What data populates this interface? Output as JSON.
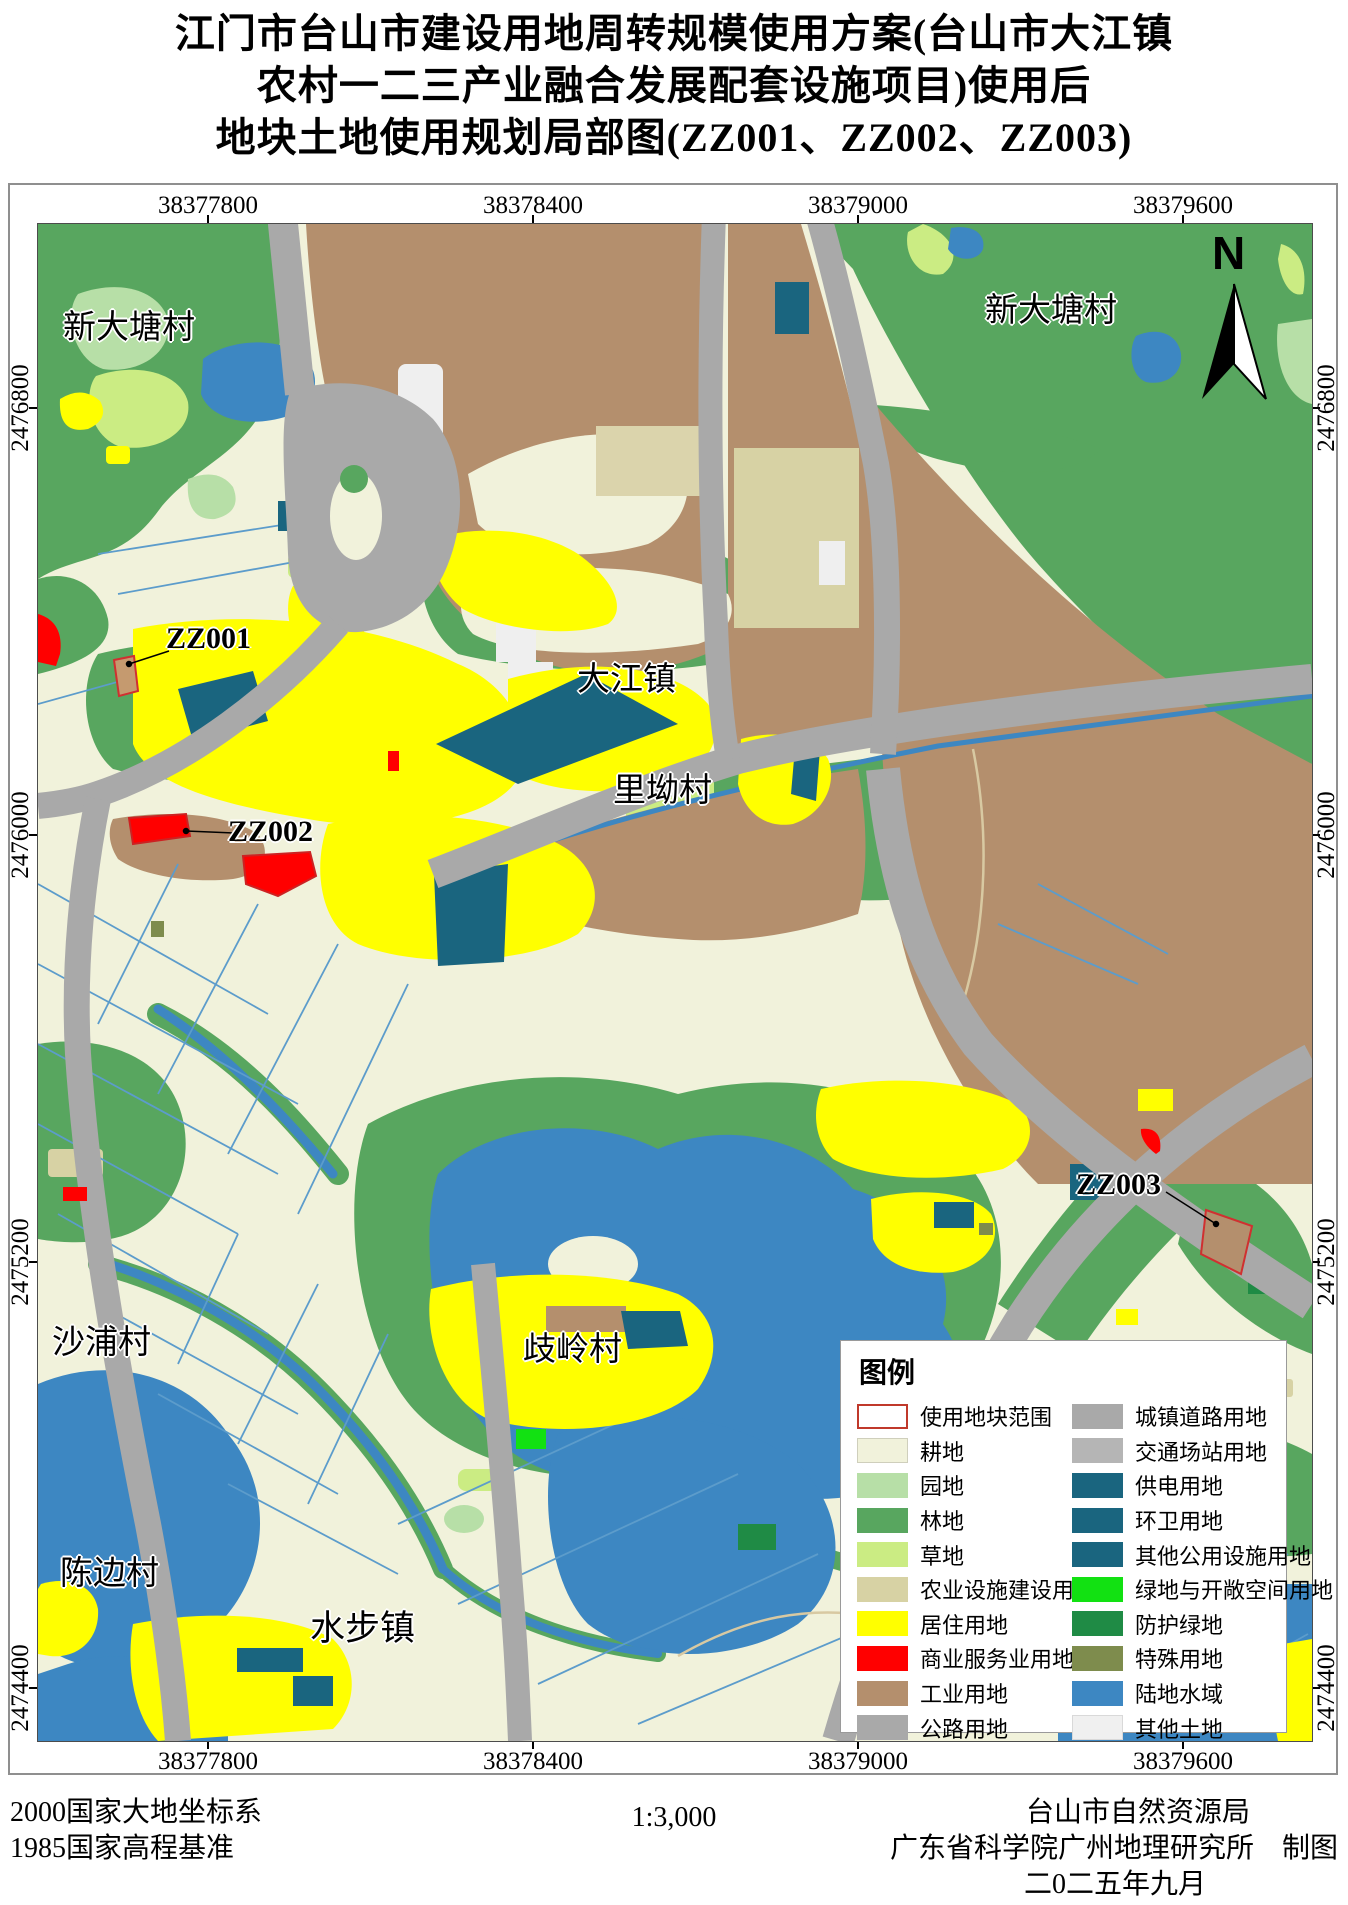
{
  "title": {
    "line1": "江门市台山市建设用地周转规模使用方案(台山市大江镇",
    "line2": "农村一二三产业融合发展配套设施项目)使用后",
    "line3": "地块土地使用规划局部图(ZZ001、ZZ002、ZZ003)"
  },
  "map": {
    "north_label": "N",
    "x_ticks": [
      "38377800",
      "38378400",
      "38379000",
      "38379600"
    ],
    "y_ticks": [
      "2476800",
      "2476000",
      "2475200",
      "2474400"
    ],
    "labels": {
      "xindatang_left": "新大塘村",
      "xindatang_right": "新大塘村",
      "dajiang": "大江镇",
      "liao": "里坳村",
      "shapu": "沙浦村",
      "qiling": "歧岭村",
      "chenbian": "陈边村",
      "shuibu": "水步镇"
    },
    "parcels": {
      "zz001": "ZZ001",
      "zz002": "ZZ002",
      "zz003": "ZZ003"
    }
  },
  "legend": {
    "title": "图例",
    "columns": [
      [
        {
          "label": "使用地块范围",
          "color": "#FFFFFF",
          "border": "2px solid #C0392B"
        },
        {
          "label": "耕地",
          "color": "#F1F2DB",
          "border": "1px solid #cfcfbc"
        },
        {
          "label": "园地",
          "color": "#B7DFA7"
        },
        {
          "label": "林地",
          "color": "#58A65F"
        },
        {
          "label": "草地",
          "color": "#CBEC83"
        },
        {
          "label": "农业设施建设用地",
          "color": "#D7D2A4"
        },
        {
          "label": "居住用地",
          "color": "#FFFF00"
        },
        {
          "label": "商业服务业用地",
          "color": "#FF0000"
        },
        {
          "label": "工业用地",
          "color": "#B48F6D"
        },
        {
          "label": "公路用地",
          "color": "#A9A9A9"
        }
      ],
      [
        {
          "label": "城镇道路用地",
          "color": "#A9A9A9"
        },
        {
          "label": "交通场站用地",
          "color": "#B5B5B5"
        },
        {
          "label": "供电用地",
          "color": "#1A657F"
        },
        {
          "label": "环卫用地",
          "color": "#1A657F"
        },
        {
          "label": "其他公用设施用地",
          "color": "#1A657F"
        },
        {
          "label": "绿地与开敞空间用地",
          "color": "#12E112"
        },
        {
          "label": "防护绿地",
          "color": "#1F8B45"
        },
        {
          "label": "特殊用地",
          "color": "#7E8C4D"
        },
        {
          "label": "陆地水域",
          "color": "#3D87C2"
        },
        {
          "label": "其他土地",
          "color": "#F0F0F0",
          "border": "1px solid #d9d9d9"
        }
      ]
    ]
  },
  "footer": {
    "datum1": "2000国家大地坐标系",
    "datum2": "1985国家高程基准",
    "scale": "1:3,000",
    "agency1": "台山市自然资源局",
    "agency2": "广东省科学院广州地理研究所　制图",
    "date": "二0二五年九月"
  }
}
